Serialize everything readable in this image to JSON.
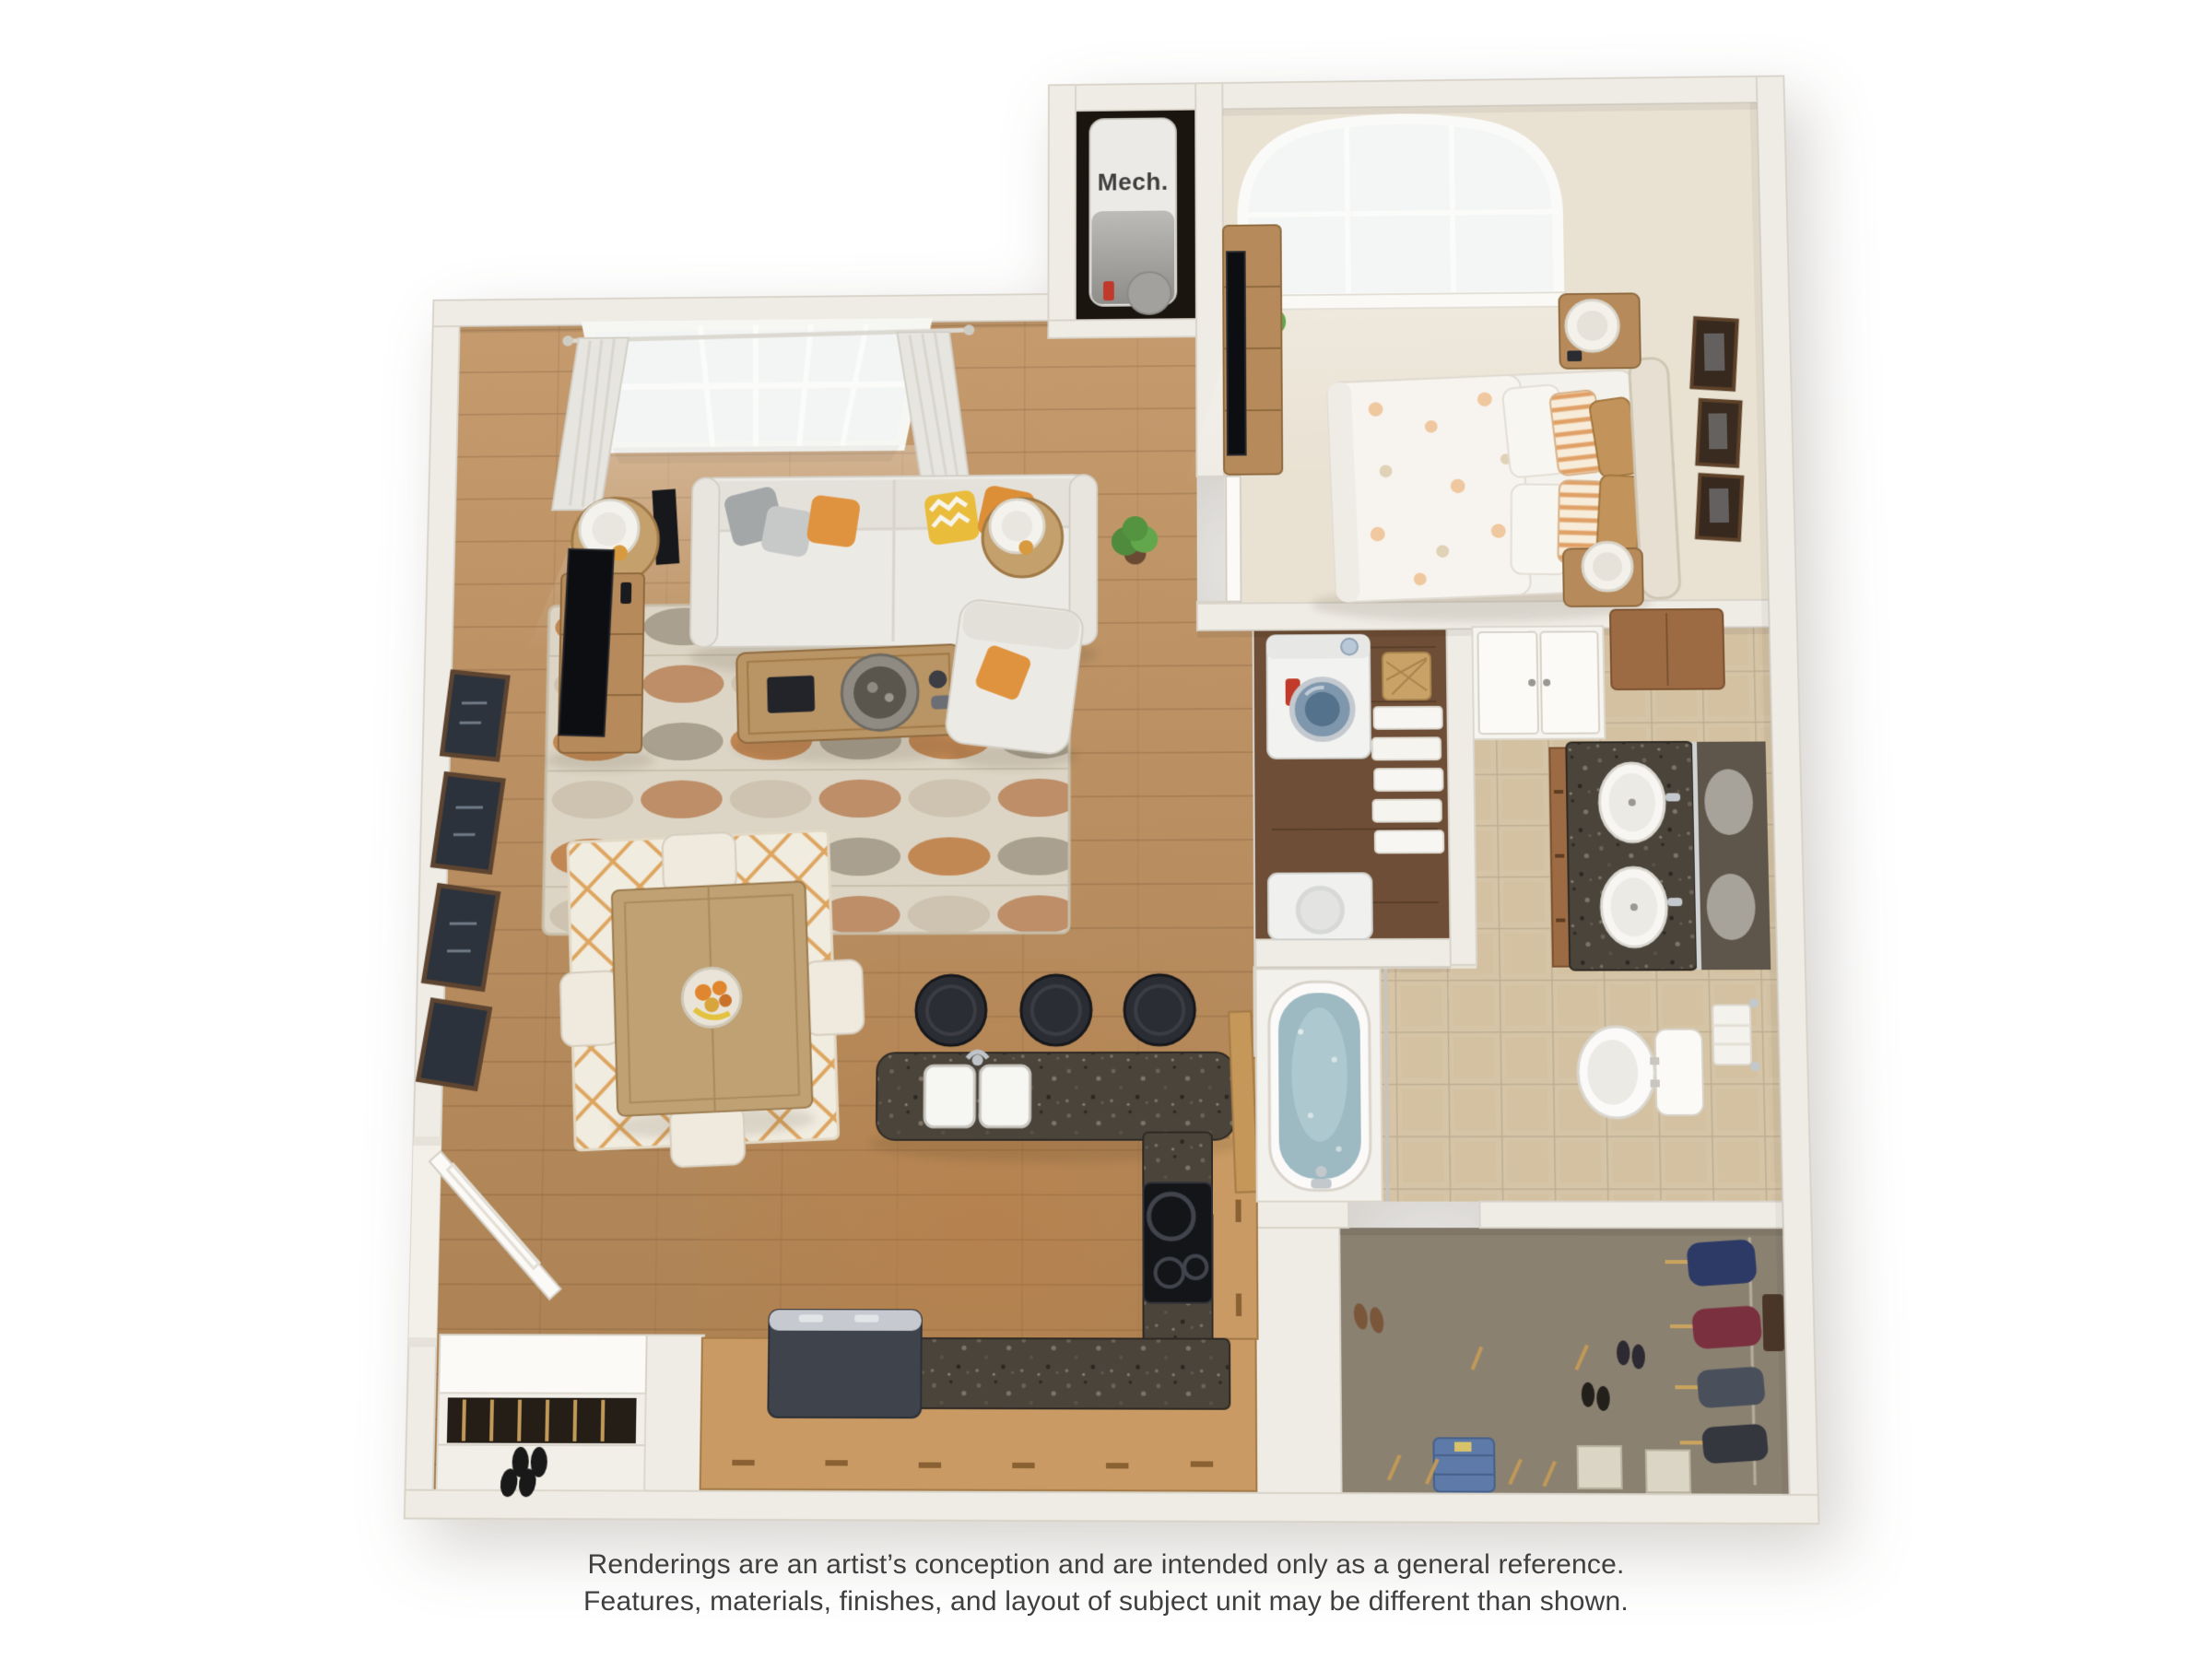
{
  "floorplan": {
    "labels": {
      "mech_closet": "Mech."
    },
    "disclaimer": {
      "line1": "Renderings are an artist’s conception and are intended only as a general reference.",
      "line2": "Features, materials, finishes, and layout of subject unit may be different than shown."
    },
    "rooms": [
      {
        "name": "living-room",
        "floor": "hardwood",
        "furniture": [
          "sofa",
          "throw-pillows",
          "coffee-table",
          "area-rug",
          "tv-console",
          "tv",
          "round-side-tables",
          "table-lamps",
          "floor-speakers",
          "armchair",
          "wall-art-frames",
          "double-window-with-curtains",
          "potted-plant"
        ]
      },
      {
        "name": "dining-area",
        "floor": "hardwood",
        "furniture": [
          "square-dining-table",
          "four-upholstered-chairs",
          "fruit-bowl",
          "lattice-rug"
        ]
      },
      {
        "name": "kitchen",
        "floor": "hardwood",
        "furniture": [
          "island-with-double-sink",
          "three-bar-stools",
          "cooktop",
          "refrigerator",
          "granite-counters",
          "wood-cabinets"
        ]
      },
      {
        "name": "bedroom",
        "floor": "carpet",
        "furniture": [
          "bed",
          "upholstered-headboard",
          "floral-duvet",
          "two-nightstands",
          "table-lamps",
          "dresser",
          "tv",
          "arched-window",
          "wall-art-frames",
          "potted-plant"
        ]
      },
      {
        "name": "bathroom",
        "floor": "tile",
        "furniture": [
          "double-sink-vanity",
          "mirror",
          "toilet",
          "soaking-tub",
          "shower-rod",
          "linen-closet",
          "wall-cabinet",
          "towel-bar"
        ]
      },
      {
        "name": "laundry-closet",
        "floor": "dark-hardwood",
        "furniture": [
          "washer",
          "dryer",
          "linen-shelves",
          "wicker-basket"
        ]
      },
      {
        "name": "walk-in-closet",
        "floor": "carpet",
        "furniture": [
          "hanging-clothes",
          "shoes",
          "boots",
          "storage-boxes",
          "folded-jeans",
          "hangers"
        ]
      },
      {
        "name": "mech-closet",
        "floor": "dark",
        "furniture": [
          "water-heater"
        ]
      },
      {
        "name": "entry",
        "floor": "hardwood",
        "furniture": [
          "front-door",
          "entry-closet-with-shoe-shelf"
        ]
      }
    ],
    "palette": {
      "background": "#ffffff",
      "wall": "#efece5",
      "wall_stroke": "#d9d4ca",
      "wood_floor": "#c59b6e",
      "wood_floor_dark": "#aa8052",
      "carpet": "#e9e1d2",
      "tile": "#d6c4a6",
      "tile_grout": "#bfae92",
      "laundry_floor": "#6e4e36",
      "closet_floor": "#8a8171",
      "granite": "#4a443b",
      "cabinet_tan": "#c99a63",
      "vanity_wood": "#9c6b43",
      "accent_orange": "#dd923c",
      "water_blue": "#9db9c2",
      "text": "#3f3f3f"
    }
  }
}
